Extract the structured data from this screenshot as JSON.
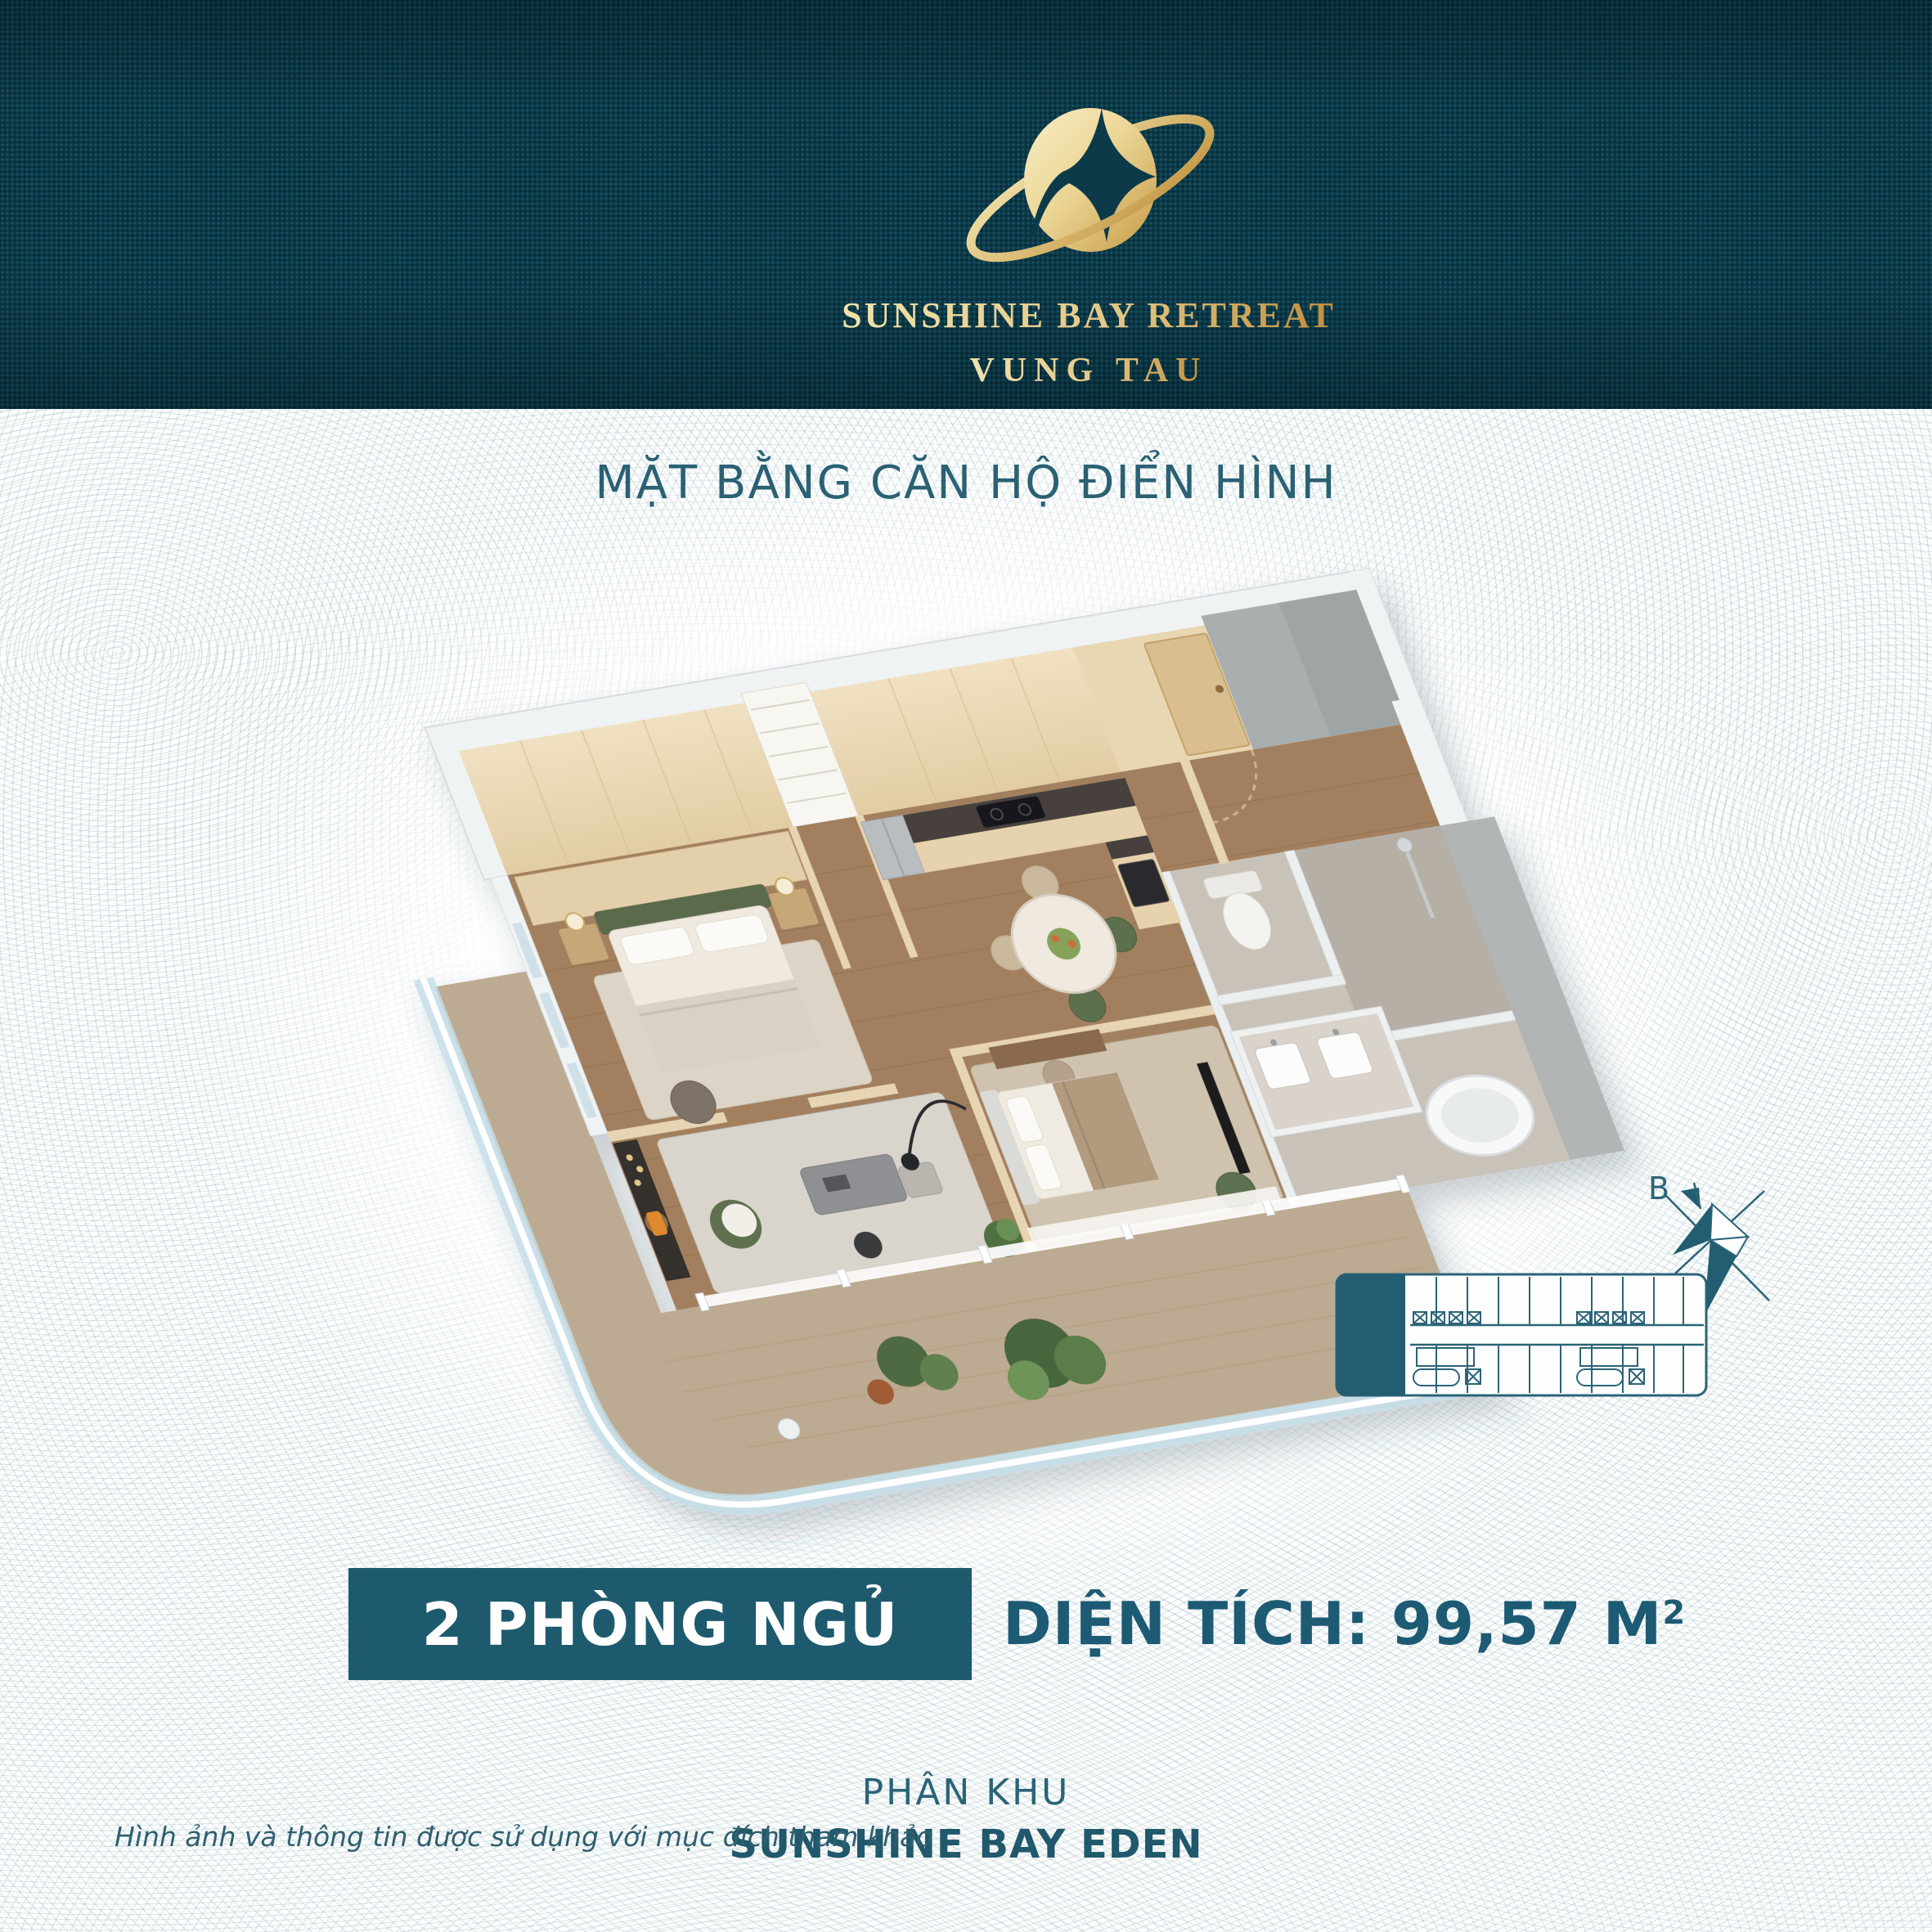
{
  "brand": {
    "line1": "SUNSHINE BAY RETREAT",
    "line2": "VUNG TAU"
  },
  "page_title": "MẶT BẰNG CĂN HỘ ĐIỂN HÌNH",
  "unit": {
    "bedrooms": "2 PHÒNG NGỦ",
    "area_label": "DIỆN TÍCH: 99,57 M",
    "area_superscript": "2"
  },
  "zone": {
    "label": "PHÂN KHU",
    "name": "SUNSHINE BAY EDEN"
  },
  "disclaimer": "Hình ảnh và thông tin được sử dụng với mục đích tham khảo",
  "compass": {
    "north_label": "B"
  },
  "colors": {
    "header_bg": "#0c3a49",
    "gold": "#cfa54f",
    "accent_teal": "#1d5a6e",
    "title_teal": "#2a6173",
    "diagram_teal": "#2b6478",
    "wave_line": "#96b4bc"
  }
}
